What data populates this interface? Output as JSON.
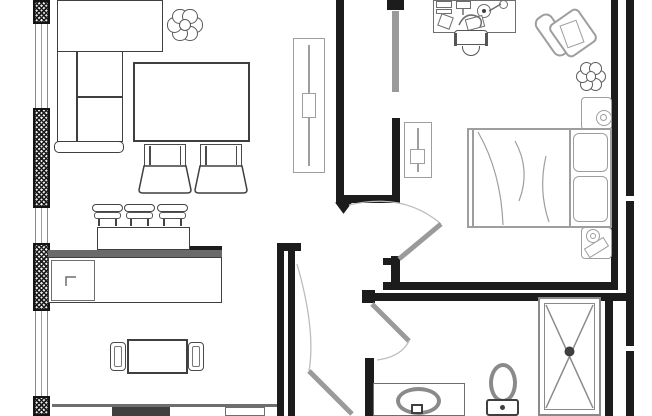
{
  "meta": {
    "type": "apartment-floor-plan"
  },
  "canvas": {
    "width": 652,
    "height": 416,
    "background": "#ffffff"
  },
  "colors": {
    "wall": "#1c1c1c",
    "dark": "#3f3f3f",
    "line": "#6e6e6e",
    "light": "#9e9e9e",
    "door": "#9a9a9a",
    "arc": "#bcbcbc",
    "counter": "#6a6a6a",
    "fixture": "#8a8a8a",
    "white": "#ffffff"
  },
  "rooms": [
    {
      "name": "living-room",
      "furniture": [
        "corner-sofa",
        "coffee-table",
        "ottomans",
        "plant",
        "tv-cabinet"
      ]
    },
    {
      "name": "kitchen-dining",
      "furniture": [
        "island-bar",
        "bar-stools",
        "dining-table",
        "dining-chairs",
        "cooktop",
        "sink"
      ]
    },
    {
      "name": "bedroom",
      "furniture": [
        "desk",
        "desk-chair",
        "armchair",
        "plant",
        "nightstands",
        "double-bed",
        "dresser"
      ]
    },
    {
      "name": "walk-in-closet",
      "furniture": [
        "sliding-door"
      ]
    },
    {
      "name": "bathroom",
      "furniture": [
        "vanity-sink",
        "toilet",
        "shower"
      ]
    },
    {
      "name": "hallway",
      "furniture": [
        "entry-door"
      ]
    }
  ],
  "items": [
    {
      "name": "left-wall-pier-1",
      "type": "pier",
      "x": 33,
      "y": 0,
      "w": 17,
      "h": 24
    },
    {
      "name": "left-wall-window-1",
      "type": "window",
      "x": 35,
      "y": 24,
      "w": 13,
      "h": 84
    },
    {
      "name": "left-wall-pier-2",
      "type": "pier",
      "x": 33,
      "y": 108,
      "w": 17,
      "h": 100
    },
    {
      "name": "left-wall-window-2",
      "type": "window",
      "x": 35,
      "y": 208,
      "w": 13,
      "h": 35
    },
    {
      "name": "left-wall-pier-3",
      "type": "pier",
      "x": 33,
      "y": 243,
      "w": 17,
      "h": 68
    },
    {
      "name": "left-wall-window-3",
      "type": "window",
      "x": 35,
      "y": 311,
      "w": 13,
      "h": 85
    },
    {
      "name": "left-wall-pier-4",
      "type": "pier",
      "x": 33,
      "y": 396,
      "w": 17,
      "h": 20
    },
    {
      "name": "closet-wall-left",
      "type": "solid",
      "x": 336,
      "y": 0,
      "w": 8,
      "h": 203
    },
    {
      "name": "closet-wall-bottom",
      "type": "solid",
      "x": 336,
      "y": 195,
      "w": 64,
      "h": 8
    },
    {
      "name": "closet-wall-right",
      "type": "solid",
      "x": 392,
      "y": 118,
      "w": 8,
      "h": 85
    },
    {
      "name": "closet-door-jamb",
      "type": "solid",
      "x": 387,
      "y": 0,
      "w": 17,
      "h": 10
    },
    {
      "name": "closet-sliding-door",
      "type": "solid",
      "x": 392,
      "y": 11,
      "w": 7,
      "h": 81,
      "color": "door"
    },
    {
      "name": "bedroom-wall-right",
      "type": "solid",
      "x": 611,
      "y": 0,
      "w": 7,
      "h": 286
    },
    {
      "name": "bedroom-wall-bottom",
      "type": "solid",
      "x": 383,
      "y": 282,
      "w": 235,
      "h": 8
    },
    {
      "name": "bathroom-wall-top",
      "type": "solid",
      "x": 362,
      "y": 293,
      "w": 272,
      "h": 8
    },
    {
      "name": "bathroom-wall-corner",
      "type": "solid",
      "x": 362,
      "y": 290,
      "w": 13,
      "h": 13
    },
    {
      "name": "bathroom-wall-left-stub",
      "type": "solid",
      "x": 365,
      "y": 358,
      "w": 9,
      "h": 58
    },
    {
      "name": "bedroom-door-stub",
      "type": "solid",
      "x": 391,
      "y": 256,
      "w": 9,
      "h": 28
    },
    {
      "name": "bedroom-door-stub-cap",
      "type": "solid",
      "x": 383,
      "y": 258,
      "w": 17,
      "h": 7
    },
    {
      "name": "hallway-wall-outer",
      "type": "solid",
      "x": 277,
      "y": 248,
      "w": 7,
      "h": 168
    },
    {
      "name": "hallway-wall-inner",
      "type": "solid",
      "x": 288,
      "y": 248,
      "w": 7,
      "h": 168
    },
    {
      "name": "hallway-wall-hook",
      "type": "solid",
      "x": 277,
      "y": 243,
      "w": 24,
      "h": 8
    },
    {
      "name": "right-exterior-wall",
      "type": "solid",
      "x": 626,
      "y": 0,
      "w": 8,
      "h": 416
    },
    {
      "name": "right-wall-break-1",
      "type": "solid",
      "x": 626,
      "y": 196,
      "w": 8,
      "h": 5,
      "color": "white"
    },
    {
      "name": "right-wall-break-2",
      "type": "solid",
      "x": 626,
      "y": 346,
      "w": 8,
      "h": 5,
      "color": "white"
    },
    {
      "name": "shower-side-wall",
      "type": "solid",
      "x": 605,
      "y": 293,
      "w": 8,
      "h": 123
    },
    {
      "name": "island-end-wall",
      "type": "solid",
      "x": 188,
      "y": 246,
      "w": 34,
      "h": 13
    },
    {
      "name": "sofa-chaise",
      "type": "box",
      "x": 57,
      "y": 0,
      "w": 106,
      "h": 52,
      "stroke": "dark"
    },
    {
      "name": "sofa-body",
      "type": "box",
      "x": 57,
      "y": 51,
      "w": 66,
      "h": 91,
      "stroke": "dark"
    },
    {
      "name": "sofa-backrest-line",
      "type": "vline",
      "x": 76,
      "y": 51,
      "h": 91,
      "color": "dark"
    },
    {
      "name": "sofa-cushion-line",
      "type": "hline",
      "x": 76,
      "y": 96,
      "w": 47,
      "color": "dark"
    },
    {
      "name": "sofa-armrest",
      "type": "box",
      "x": 54,
      "y": 141,
      "w": 70,
      "h": 12,
      "stroke": "dark",
      "r": 5
    },
    {
      "name": "living-plant",
      "type": "plant",
      "x": 167,
      "y": 7,
      "w": 36,
      "h": 36
    },
    {
      "name": "coffee-table",
      "type": "box",
      "x": 133,
      "y": 62,
      "w": 117,
      "h": 80,
      "stroke": "dark",
      "bw": 2
    },
    {
      "name": "ottoman-1-seat",
      "type": "ottoman-top",
      "x": 144,
      "y": 144,
      "w": 42,
      "h": 23
    },
    {
      "name": "ottoman-2-seat",
      "type": "ottoman-top",
      "x": 200,
      "y": 144,
      "w": 42,
      "h": 23
    },
    {
      "name": "tv-cabinet",
      "type": "box",
      "x": 293,
      "y": 38,
      "w": 32,
      "h": 135,
      "stroke": "light"
    },
    {
      "name": "tv-cabinet-line",
      "type": "vline",
      "x": 308,
      "y": 45,
      "h": 121,
      "color": "light"
    },
    {
      "name": "tv-cabinet-handle",
      "type": "box",
      "x": 302,
      "y": 93,
      "w": 14,
      "h": 25,
      "stroke": "light"
    },
    {
      "name": "dresser",
      "type": "box",
      "x": 404,
      "y": 122,
      "w": 28,
      "h": 56,
      "stroke": "light"
    },
    {
      "name": "dresser-line",
      "type": "vline",
      "x": 417,
      "y": 128,
      "h": 44,
      "color": "light"
    },
    {
      "name": "dresser-handle",
      "type": "box",
      "x": 410,
      "y": 149,
      "w": 15,
      "h": 15,
      "stroke": "light"
    },
    {
      "name": "island-bar-counter",
      "type": "box",
      "x": 97,
      "y": 227,
      "w": 93,
      "h": 23,
      "stroke": "dark"
    },
    {
      "name": "island-counter-edge",
      "type": "solid",
      "x": 48,
      "y": 250,
      "w": 174,
      "h": 8,
      "color": "counter"
    },
    {
      "name": "island-body",
      "type": "box",
      "x": 48,
      "y": 257,
      "w": 174,
      "h": 46,
      "stroke": "dark"
    },
    {
      "name": "island-cabinet",
      "type": "box",
      "x": 51,
      "y": 260,
      "w": 44,
      "h": 41,
      "stroke": "line"
    },
    {
      "name": "bar-stool-1",
      "type": "stool",
      "x": 92,
      "y": 204,
      "w": 31,
      "h": 22
    },
    {
      "name": "bar-stool-2",
      "type": "stool",
      "x": 124,
      "y": 204,
      "w": 31,
      "h": 22
    },
    {
      "name": "bar-stool-3",
      "type": "stool",
      "x": 157,
      "y": 204,
      "w": 31,
      "h": 22
    },
    {
      "name": "dining-table",
      "type": "box",
      "x": 127,
      "y": 339,
      "w": 61,
      "h": 35,
      "stroke": "dark",
      "bw": 2
    },
    {
      "name": "dining-chair-left",
      "type": "dchair",
      "x": 110,
      "y": 342,
      "w": 16,
      "h": 29
    },
    {
      "name": "dining-chair-right",
      "type": "dchair",
      "x": 188,
      "y": 342,
      "w": 16,
      "h": 29
    },
    {
      "name": "kitchen-counter-edge",
      "type": "hline",
      "x": 52,
      "y": 404,
      "w": 225,
      "h": 3,
      "color": "line"
    },
    {
      "name": "cooktop",
      "type": "solid",
      "x": 112,
      "y": 407,
      "w": 58,
      "h": 9,
      "color": "dark"
    },
    {
      "name": "kitchen-sink",
      "type": "box",
      "x": 225,
      "y": 407,
      "w": 40,
      "h": 9,
      "stroke": "line"
    },
    {
      "name": "desk",
      "type": "box",
      "x": 433,
      "y": 0,
      "w": 83,
      "h": 33,
      "stroke": "line"
    },
    {
      "name": "desk-monitor",
      "type": "box",
      "x": 436,
      "y": 1,
      "w": 16,
      "h": 7,
      "stroke": "line"
    },
    {
      "name": "desk-keyboard",
      "type": "box",
      "x": 436,
      "y": 9,
      "w": 16,
      "h": 5,
      "stroke": "line"
    },
    {
      "name": "desk-notepad",
      "type": "box",
      "x": 439,
      "y": 15,
      "w": 13,
      "h": 13,
      "rot": 20,
      "stroke": "line"
    },
    {
      "name": "desk-tray",
      "type": "box",
      "x": 456,
      "y": 1,
      "w": 15,
      "h": 8,
      "stroke": "line"
    },
    {
      "name": "desk-lamp",
      "type": "circle",
      "x": 477,
      "y": 4,
      "w": 14,
      "h": 14,
      "stroke": "line"
    },
    {
      "name": "desk-lamp-dot",
      "type": "dot",
      "x": 482,
      "y": 9,
      "w": 4,
      "h": 4,
      "color": "dark"
    },
    {
      "name": "desk-lamp-head",
      "type": "circle",
      "x": 499,
      "y": 0,
      "w": 9,
      "h": 9,
      "stroke": "line"
    },
    {
      "name": "desk-papers",
      "type": "box",
      "x": 466,
      "y": 17,
      "w": 18,
      "h": 12,
      "rot": -15,
      "stroke": "line"
    },
    {
      "name": "desk-chair",
      "type": "chair2",
      "x": 454,
      "y": 30,
      "w": 34,
      "h": 27
    },
    {
      "name": "armchair-back",
      "type": "box",
      "x": 543,
      "y": 12,
      "w": 20,
      "h": 46,
      "stroke": "light",
      "bw": 2,
      "r": 8,
      "rot": -35
    },
    {
      "name": "armchair-seat",
      "type": "box",
      "x": 555,
      "y": 13,
      "w": 36,
      "h": 40,
      "stroke": "light",
      "bw": 2,
      "r": 6,
      "rot": -35
    },
    {
      "name": "armchair-throw",
      "type": "box",
      "x": 563,
      "y": 22,
      "w": 18,
      "h": 24,
      "stroke": "light",
      "rot": -20
    },
    {
      "name": "bedroom-plant",
      "type": "plant",
      "x": 574,
      "y": 61,
      "w": 34,
      "h": 31
    },
    {
      "name": "nightstand-top",
      "type": "box",
      "x": 581,
      "y": 97,
      "w": 31,
      "h": 33,
      "stroke": "light",
      "r": 4
    },
    {
      "name": "nightstand-top-lamp",
      "type": "circle",
      "x": 596,
      "y": 110,
      "w": 16,
      "h": 16,
      "stroke": "light"
    },
    {
      "name": "nightstand-top-lamp-inner",
      "type": "circle",
      "x": 600,
      "y": 114,
      "w": 7,
      "h": 7,
      "stroke": "light"
    },
    {
      "name": "bed",
      "type": "box",
      "x": 467,
      "y": 128,
      "w": 145,
      "h": 100,
      "stroke": "light",
      "bw": 2
    },
    {
      "name": "bed-foot-line",
      "type": "vline",
      "x": 472,
      "y": 130,
      "h": 96,
      "color": "light"
    },
    {
      "name": "bed-pillow-line",
      "type": "vline",
      "x": 569,
      "y": 130,
      "h": 96,
      "color": "light"
    },
    {
      "name": "bed-pillow-1",
      "type": "box",
      "x": 573,
      "y": 133,
      "w": 35,
      "h": 39,
      "stroke": "light",
      "r": 6
    },
    {
      "name": "bed-pillow-2",
      "type": "box",
      "x": 573,
      "y": 176,
      "w": 35,
      "h": 46,
      "stroke": "light",
      "r": 6
    },
    {
      "name": "nightstand-bottom",
      "type": "box",
      "x": 581,
      "y": 227,
      "w": 31,
      "h": 32,
      "stroke": "light",
      "r": 4
    },
    {
      "name": "nightstand-bottom-lamp",
      "type": "circle",
      "x": 586,
      "y": 229,
      "w": 14,
      "h": 14,
      "stroke": "light"
    },
    {
      "name": "nightstand-bottom-lamp-inner",
      "type": "circle",
      "x": 590,
      "y": 233,
      "w": 6,
      "h": 6,
      "stroke": "light"
    },
    {
      "name": "nightstand-book",
      "type": "box",
      "x": 585,
      "y": 242,
      "w": 23,
      "h": 11,
      "rot": -32,
      "stroke": "light"
    },
    {
      "name": "shower",
      "type": "box",
      "x": 538,
      "y": 297,
      "w": 63,
      "h": 119,
      "stroke": "fixture",
      "bw": 2
    },
    {
      "name": "shower-inner",
      "type": "box",
      "x": 544,
      "y": 303,
      "w": 51,
      "h": 107,
      "stroke": "fixture"
    },
    {
      "name": "vanity",
      "type": "box",
      "x": 373,
      "y": 383,
      "w": 92,
      "h": 33,
      "stroke": "line"
    },
    {
      "name": "sink-basin",
      "type": "circle",
      "x": 396,
      "y": 387,
      "w": 45,
      "h": 28,
      "stroke": "fixture",
      "bw": 4
    },
    {
      "name": "sink-tap",
      "type": "box",
      "x": 411,
      "y": 404,
      "w": 12,
      "h": 10,
      "stroke": "dark",
      "bw": 2
    },
    {
      "name": "toilet-bowl",
      "type": "circle",
      "x": 489,
      "y": 363,
      "w": 28,
      "h": 40,
      "stroke": "fixture",
      "bw": 4
    },
    {
      "name": "toilet-tank",
      "type": "box",
      "x": 486,
      "y": 399,
      "w": 33,
      "h": 17,
      "stroke": "dark",
      "bw": 2,
      "r": 3
    },
    {
      "name": "toilet-button",
      "type": "dot",
      "x": 500,
      "y": 405,
      "w": 5,
      "h": 5,
      "color": "dark"
    }
  ],
  "paths": [
    {
      "name": "closet-wall-tip",
      "d": "M336 203 L343.5 213 L351 203 Z",
      "stroke": "wall",
      "w": 1,
      "fill": "wall"
    },
    {
      "name": "ottoman-1-base",
      "d": "M139 190 L144 166 L186 166 L191 190 Q191 193 187 193 L143 193 Q139 193 139 190 Z",
      "stroke": "dark",
      "w": 1.5,
      "fill": "white"
    },
    {
      "name": "ottoman-2-base",
      "d": "M195 190 L200 166 L242 166 L247 190 Q247 193 243 193 L199 193 Q195 193 195 190 Z",
      "stroke": "dark",
      "w": 1.5,
      "fill": "white"
    },
    {
      "name": "island-corner-mark",
      "d": "M66 286 V 277 H 76",
      "stroke": "line",
      "w": 1.5,
      "fill": "none"
    },
    {
      "name": "bedroom-door-arc",
      "d": "M441 224 Q 404 192 349 205",
      "stroke": "arc",
      "w": 1.3,
      "fill": "none"
    },
    {
      "name": "bedroom-door",
      "d": "M399 259 L441 224",
      "stroke": "door",
      "w": 5,
      "fill": "none"
    },
    {
      "name": "bathroom-door",
      "d": "M372 304 L409 341",
      "stroke": "door",
      "w": 5,
      "fill": "none"
    },
    {
      "name": "bathroom-door-arc",
      "d": "M409 341 Q 401 357 377 360",
      "stroke": "arc",
      "w": 1.3,
      "fill": "none"
    },
    {
      "name": "entry-door-arc",
      "d": "M297 264 Q 316 330 309 371",
      "stroke": "arc",
      "w": 1.3,
      "fill": "none"
    },
    {
      "name": "entry-door",
      "d": "M309 371 L352 414",
      "stroke": "door",
      "w": 5,
      "fill": "none"
    },
    {
      "name": "shower-cross",
      "d": "M546 305 L593 408 M593 305 L546 408",
      "stroke": "fixture",
      "w": 1.5,
      "fill": "none"
    },
    {
      "name": "shower-drain",
      "d": "M569.5 351.5 m-4.5 0 a4.5 4.5 0 1 0 9 0 a4.5 4.5 0 1 0 -9 0",
      "stroke": "dark",
      "w": 1,
      "fill": "dark"
    },
    {
      "name": "bed-blanket-fold-1",
      "d": "M478 132 Q 501 172 503 225",
      "stroke": "light",
      "w": 1.2,
      "fill": "none"
    },
    {
      "name": "bed-blanket-fold-2",
      "d": "M515 141 Q 531 170 519 201",
      "stroke": "light",
      "w": 1.2,
      "fill": "none"
    },
    {
      "name": "bed-blanket-fold-3",
      "d": "M546 156 Q 538 190 549 222",
      "stroke": "light",
      "w": 1.2,
      "fill": "none"
    },
    {
      "name": "desk-lamp-arm",
      "d": "M489 11 L501 4",
      "stroke": "line",
      "w": 1.5,
      "fill": "none"
    },
    {
      "name": "desk-tray-stem",
      "d": "M463 9 L463 15",
      "stroke": "line",
      "w": 1.5,
      "fill": "none"
    },
    {
      "name": "desk-phone-cord",
      "d": "M459 25 Q 465 12 476 16 Q 484 19 480 27",
      "stroke": "line",
      "w": 1.5,
      "fill": "none"
    }
  ]
}
